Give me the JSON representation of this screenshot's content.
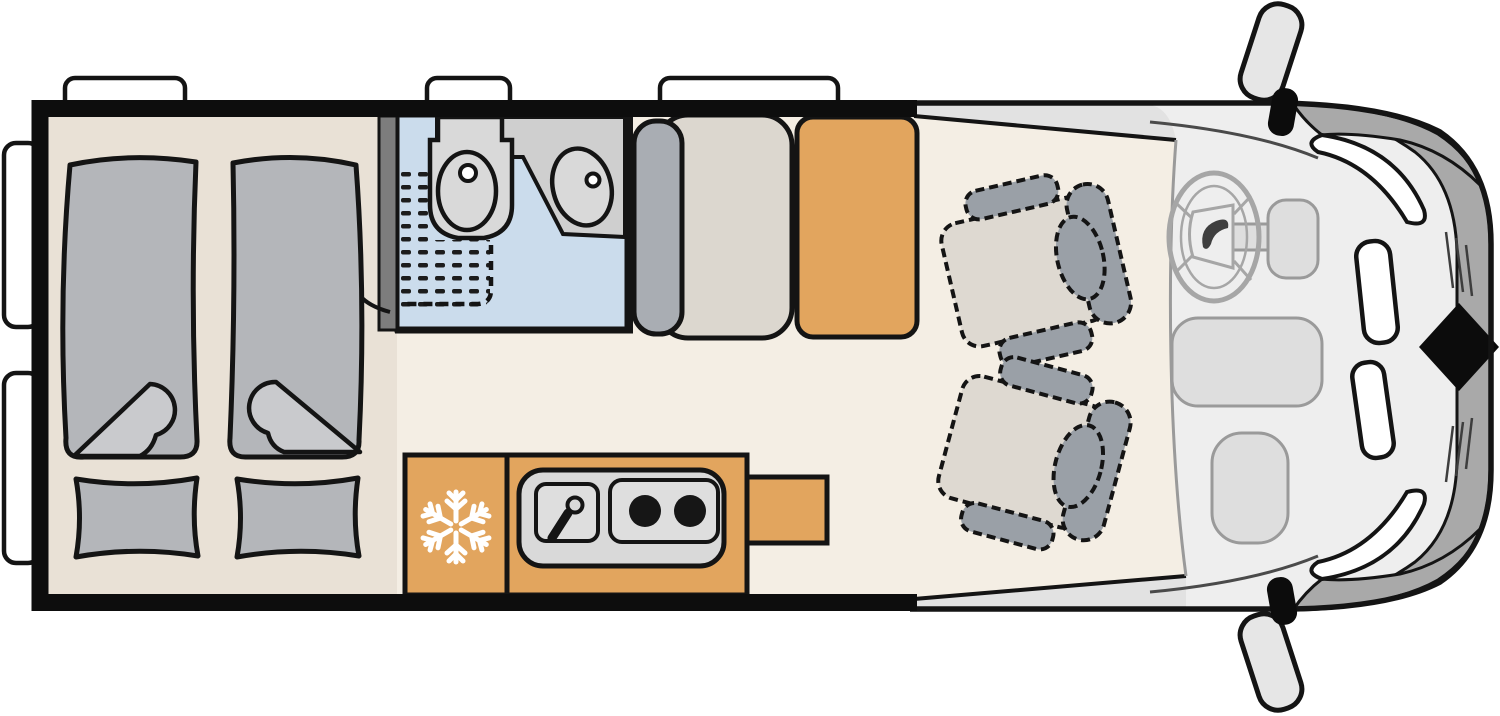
{
  "meta": {
    "type": "motorhome-floorplan",
    "view": "top-down",
    "vehicle_front": "right"
  },
  "icons": {
    "fridge_snowflake": "❄",
    "door_swing": "curved-arrow",
    "steering_logo": "leaf-swoosh",
    "front_marker": "black-diamond"
  },
  "colors": {
    "line": "#141414",
    "wall": "#0d0d0d",
    "window": "#ffffff",
    "floorLiving": "#f4eee4",
    "floorBedroom": "#e9e1d6",
    "cabFloor": "#eeeeee",
    "step": "#e2e2e2",
    "boundary": "#9a9a9a",
    "bathFloor": "#cbdcec",
    "fixture": "#d9d9d9",
    "fixtureShadow": "#cfcfcf",
    "partition": "#7d7d7d",
    "bedDuvet": "#b4b6ba",
    "bedFold": "#c9cacd",
    "pillow": "#b4b6ba",
    "wardrobe": "#a9adb3",
    "benchCushion": "#dcd7cf",
    "furniture": "#e2a55e",
    "worktop": "#d9d9d9",
    "stovePanel": "#dedede",
    "burner": "#161616",
    "seatCushion": "#ded9d1",
    "seatFrame": "#9aa0a7",
    "dashPanel": "#dedede",
    "dashStroke": "#9a9a9a",
    "wheel": "#a6a6a6",
    "logoDark": "#3f3f3f",
    "frontBand": "#a9a9a9",
    "glassWhite": "#ffffff",
    "diamond": "#0c0c0c",
    "mirror": "#e6e6e6",
    "snowflake": "#ffffff"
  },
  "areas": [
    {
      "id": "bedroom",
      "label": "Rear bedroom, twin single beds with pillows"
    },
    {
      "id": "bathroom",
      "label": "Shower room with washbasin and toilet"
    },
    {
      "id": "dinette",
      "label": "Bench seat with dining table"
    },
    {
      "id": "kitchen",
      "label": "Kitchen: fridge, sink, two-burner stove, worktop extension"
    },
    {
      "id": "cab",
      "label": "Driver cab with two swivel seats, steering wheel and mirrors"
    }
  ],
  "counts": {
    "beds": 2,
    "pillows": 2,
    "stove_burners": 2,
    "swivel_seats": 2,
    "windows_rear_wall": 2,
    "windows_side_wall": 3,
    "mirrors": 2
  }
}
